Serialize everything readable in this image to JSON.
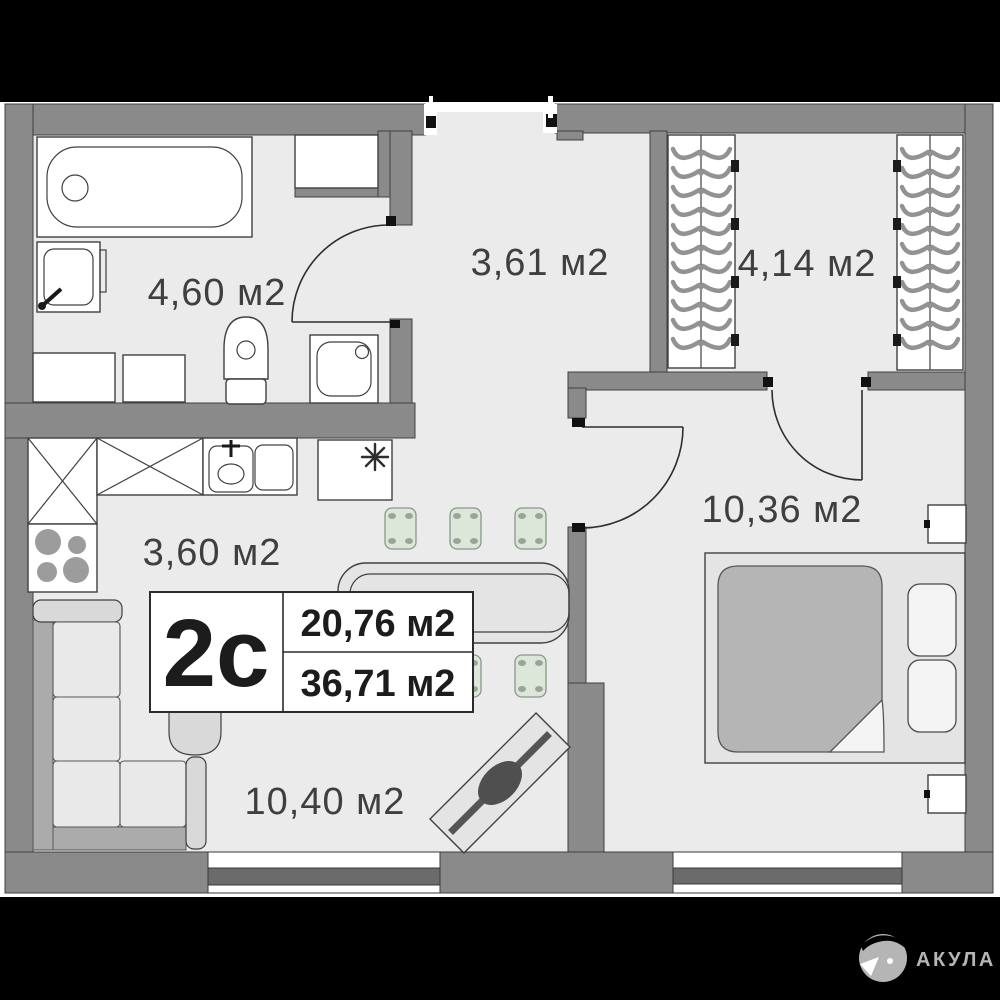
{
  "plan": {
    "unit_label": "2с",
    "area_primary": "20,76 м2",
    "area_total": "36,71 м2",
    "rooms": [
      {
        "id": "bathroom",
        "label": "4,60 м2"
      },
      {
        "id": "hallway",
        "label": "3,61 м2"
      },
      {
        "id": "wardrobe",
        "label": "4,14 м2"
      },
      {
        "id": "kitchen",
        "label": "3,60 м2"
      },
      {
        "id": "bedroom",
        "label": "10,36 м2"
      },
      {
        "id": "living",
        "label": "10,40 м2"
      }
    ],
    "icons": {
      "fridge": "snowflake-icon",
      "logo": "shark-icon"
    }
  },
  "footer": {
    "brand": "АКУЛА"
  },
  "colors": {
    "bg": "#000000",
    "paper": "#ffffff",
    "floor": "#ebebeb",
    "wall": "#8a8a8a",
    "outline": "#404040",
    "window": "#6b6b6b",
    "stool": "#dde7d9",
    "mattress": "#b5b5b5",
    "ink": "#1c1c1c",
    "label": "#3f3f3f",
    "logo": "#b5b5b5"
  }
}
